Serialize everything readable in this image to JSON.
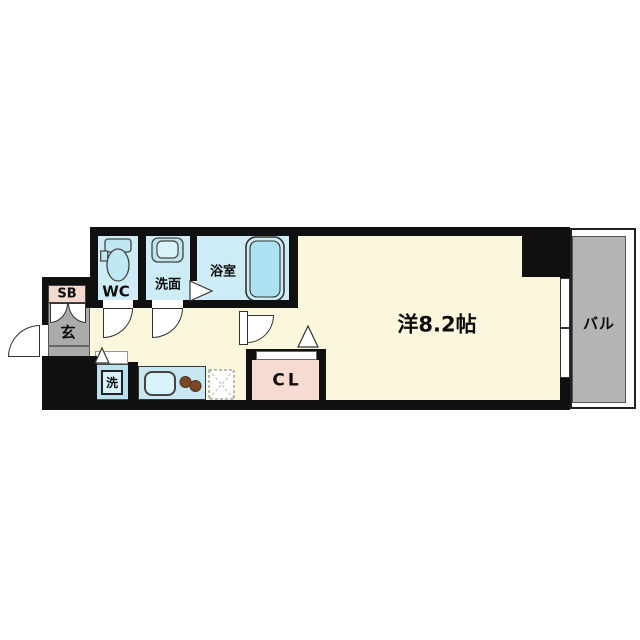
{
  "plan": {
    "labels": {
      "main_room": "洋8.2帖",
      "balcony": "バル",
      "closet": "CL",
      "shoe_box": "SB",
      "entrance": "玄",
      "toilet": "WC",
      "washroom": "洗面",
      "bathroom": "浴室",
      "laundry": "洗"
    },
    "colors": {
      "wall": "#101010",
      "floor_cream": "#FAF7DC",
      "wet_room_blue": "#CDECF5",
      "fixture_blue": "#ADE2F0",
      "fixture_light_blue": "#D9F3FA",
      "entrance_gray": "#ABABAB",
      "balcony_gray": "#B4B4B4",
      "closet_pink": "#F7DAD2",
      "shoebox_pink": "#F6D9CE",
      "stove_burner_brown": "#7A4927"
    }
  }
}
